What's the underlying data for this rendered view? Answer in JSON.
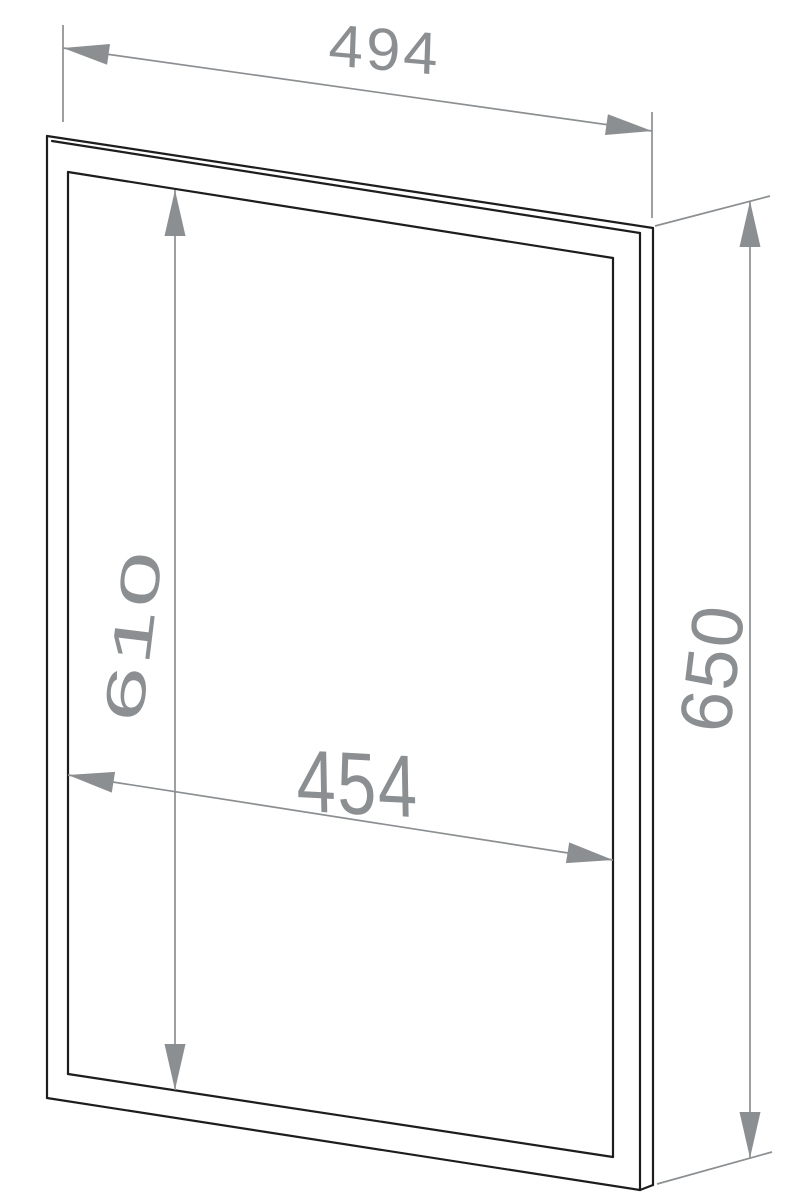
{
  "diagram": {
    "description": "Perspective line drawing of a rectangular frame (front view) with dimension annotations",
    "labels": {
      "outer_width": "494",
      "outer_height": "650",
      "inner_height": "610",
      "inner_width": "454"
    },
    "colors": {
      "background": "#ffffff",
      "outline": "#1d1d1d",
      "dimension": "#8c8f92"
    }
  }
}
